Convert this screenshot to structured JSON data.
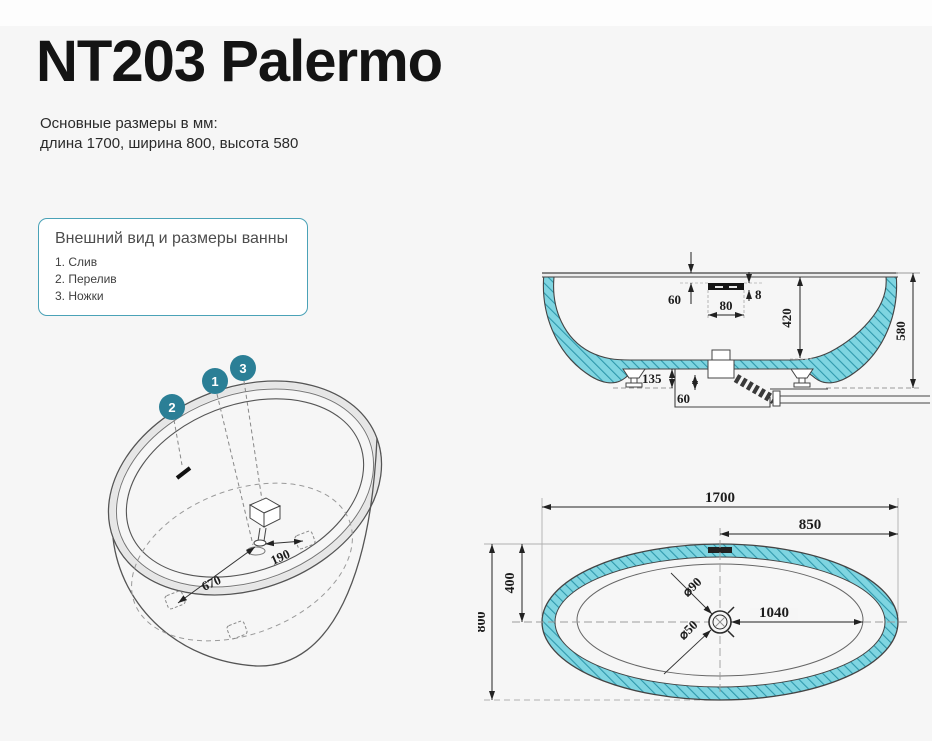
{
  "header": {
    "title": "NT203 Palermo",
    "subtitle_line1": "Основные размеры в мм:",
    "subtitle_line2": "длина 1700, ширина 800, высота 580"
  },
  "legend_box": {
    "title": "Внешний вид и размеры ванны",
    "items": [
      "1. Слив",
      "2. Перелив",
      "3. Ножки"
    ]
  },
  "iso_view": {
    "callout_drain": "1",
    "callout_overflow": "2",
    "callout_feet": "3",
    "dim_foot_to_drain": "670",
    "dim_drain_to_foot": "190"
  },
  "side_view": {
    "dim_rim_to_overflow": "60",
    "dim_overflow_width": "80",
    "dim_overflow_height": "8",
    "dim_inner_depth": "420",
    "dim_total_height": "580",
    "dim_feet_height": "135",
    "dim_drain_drop": "60"
  },
  "top_view": {
    "dim_length": "1700",
    "dim_center_to_end": "850",
    "dim_center_to_side": "400",
    "dim_width": "800",
    "dim_drain_to_end": "1040",
    "dim_drain_d90": "⌀90",
    "dim_drain_d50": "⌀50"
  },
  "colors": {
    "accent_teal": "#2b7f96",
    "tub_fill": "#7fd5e1",
    "hatch_line": "#2f98ac"
  }
}
